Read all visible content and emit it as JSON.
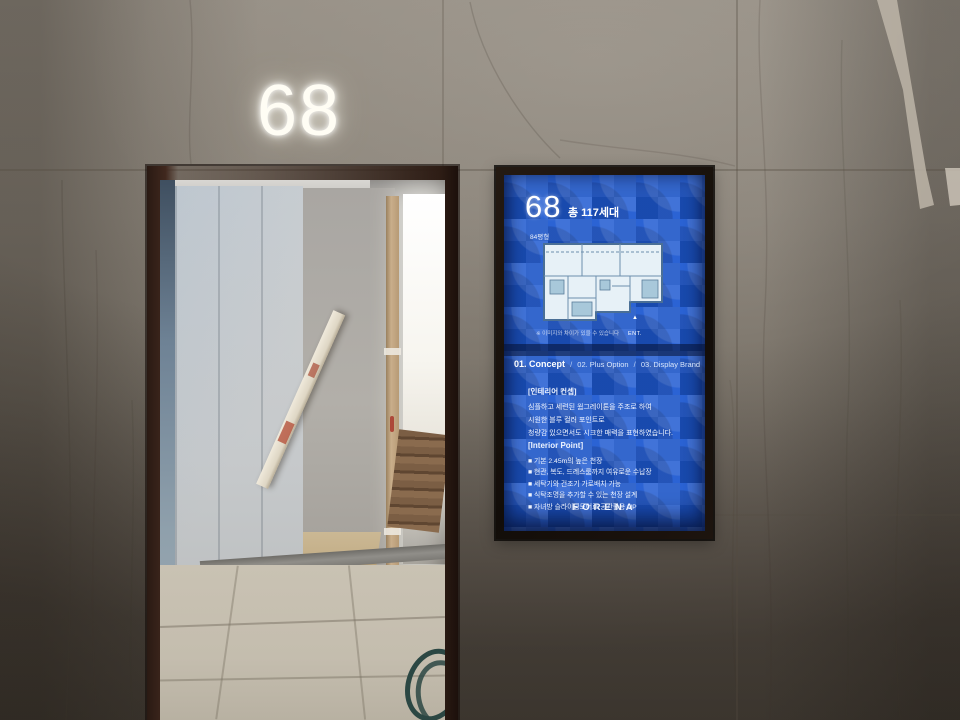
{
  "wall": {
    "door_number": "68",
    "material_colors": {
      "tile_light": "#958e84",
      "tile_dark": "#544d44",
      "tape": "#bdb5a8"
    }
  },
  "signage": {
    "colors": {
      "screen_blue": "#1d56c7",
      "pattern_light": "#2b63d4",
      "bezel": "#17110d",
      "text": "#ffffff"
    },
    "floor_number": "68",
    "unit_count": "총 117세대",
    "unit_type_label": "84평형",
    "ent_marker": {
      "icon": "triangle-up-icon",
      "label": "ENT."
    },
    "floorplan_caption": "※ 이미지와 차이가 있을 수 있습니다",
    "tab_separator": "/",
    "tabs": [
      {
        "label": "01. Concept",
        "active": true
      },
      {
        "label": "02. Plus Option",
        "active": false
      },
      {
        "label": "03. Display Brand",
        "active": false
      }
    ],
    "concept": {
      "heading": "[인테리어 컨셉]",
      "lines": [
        "심플하고 세련된 웜그레이톤을 주조로 하여",
        "시원한 블루 컬러 포인트로",
        "청량감 있으면서도 시크한 매력을 표현하였습니다."
      ]
    },
    "interior_point": {
      "heading": "[Interior Point]",
      "bullets": [
        "■ 기본 2.45m의 높은 천장",
        "■ 현관, 복도, 드레스룸까지 여유로운 수납장",
        "■ 세탁기와 건조기 가로배치 가능",
        "■ 식탁조명을 추가할 수 있는 천장 설계",
        "■ 자녀방 슬라이딩도어로 공간활용 UP"
      ]
    },
    "brand": "FORENA"
  }
}
